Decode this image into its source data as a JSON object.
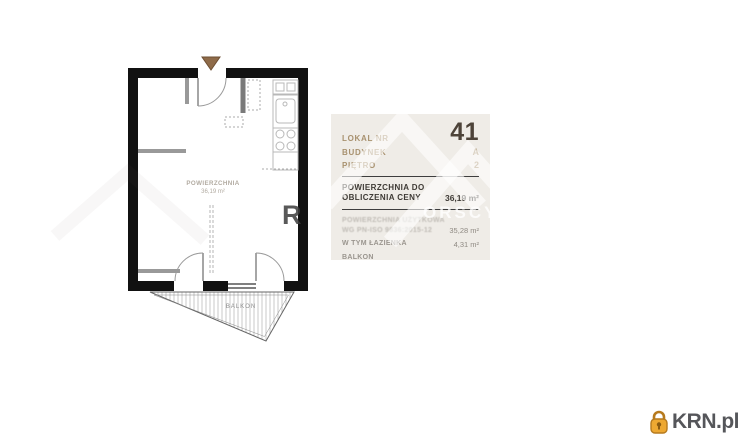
{
  "info_panel": {
    "unit": {
      "label": "LOKAL NR",
      "value": "41"
    },
    "building": {
      "label": "BUDYNEK",
      "value": "A"
    },
    "floor": {
      "label": "PIĘTRO",
      "value": "2"
    },
    "area_for_price": {
      "label": "POWIERZCHNIA DO OBLICZENIA CENY",
      "value": "36,19 m²"
    },
    "detail_rows": [
      {
        "label": "POWIERZCHNIA UŻYTKOWA",
        "label_line2": "WG PN-ISO 9836:2015-12",
        "value": "35,28 m²"
      },
      {
        "label": "W TYM ŁAZIENKA",
        "value": "4,31 m²"
      },
      {
        "label": "BALKON",
        "value": ""
      }
    ]
  },
  "floor_plan": {
    "room_label": "POWIERZCHNIA",
    "room_area": "36,19 m²",
    "balcony_label": "BALKON"
  },
  "watermark": {
    "letter_dark": "R",
    "letters_light": "ORSCY"
  },
  "logo": {
    "text": "KRN.pl",
    "icon": "padlock-icon",
    "gold": "#eda832",
    "text_color": "#55565a"
  },
  "colors": {
    "panel_bg": "#efece7",
    "label_tan": "#a8916f",
    "value_dark": "#4d4339",
    "wall_black": "#111111",
    "entrance_arrow": "#8f6b49"
  }
}
